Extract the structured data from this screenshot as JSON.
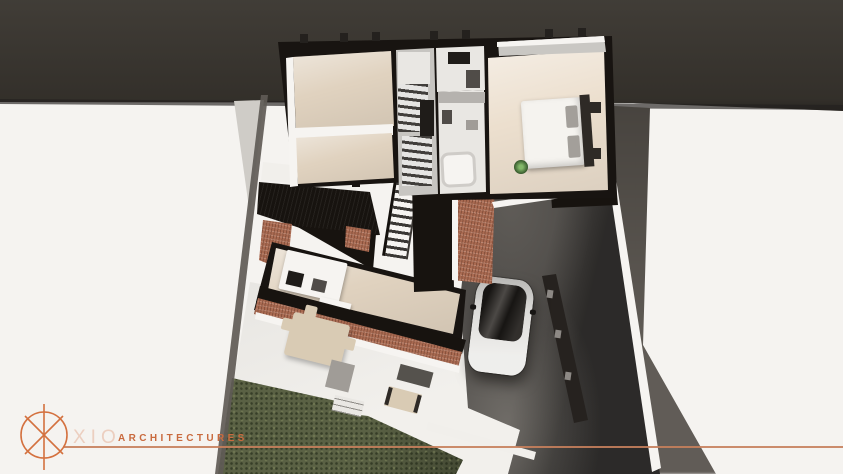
{
  "brand": {
    "name": "XIO",
    "tagline": "ARCHITECTURES",
    "logo_symbol": "circle-crosshair-x"
  },
  "colors": {
    "background": "#f5f3f0",
    "top_band": "#39352f",
    "band_edge": "#24211e",
    "shadow_soft": "#cfccc7",
    "shadow_column": "#57524c",
    "boundary_wall": "#5f5b56",
    "white_surface": "#f1efeb",
    "bright_white": "#f6f4f1",
    "wall_dark": "#181411",
    "roof_black": "#17130f",
    "floor_beige": "#e0d2bf",
    "floor_beige_light": "#ecdfce",
    "corridor_gray": "#c7c5c1",
    "bath_white": "#e9e7e3",
    "halfwall_gray": "#b5b2ae",
    "brick": "#a96a51",
    "driveway": "#4c4946",
    "grass": "#5a6144",
    "fence_dark": "#26221f",
    "fence_post": "#8d8985",
    "car_body": "#e9e8e5",
    "car_glass": "#171513",
    "bed_white": "#f5f3ef",
    "pillow_gray": "#a39f9a",
    "headboard_dark": "#2e2a26",
    "furniture_tan": "#d9cbb4",
    "rug_gray": "#a09c97",
    "mat_dark": "#55524d",
    "balcony_gray": "#c9c7c3",
    "appliance_dark": "#1f1c19",
    "appliance_gray": "#504c48",
    "accent_orange": "#d4713f",
    "rule_orange": "#c6805c",
    "logo_text_pale": "#eccfc0",
    "logo_text_orange": "#c96a3e"
  }
}
